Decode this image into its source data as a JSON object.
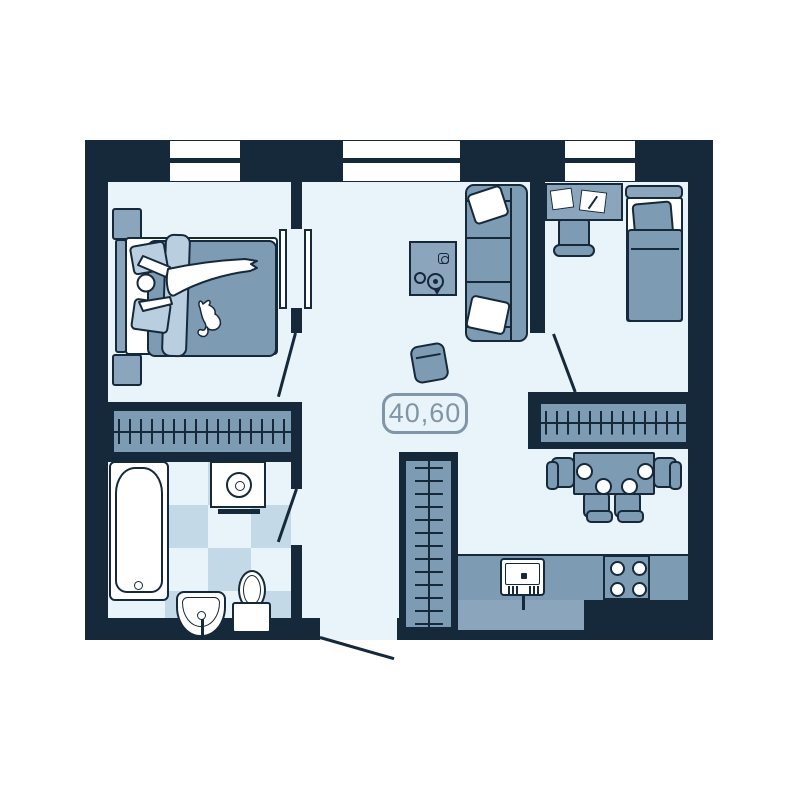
{
  "area_label": {
    "value": "40,60"
  },
  "colors": {
    "wall": "#16293A",
    "floor": "#E8F3FA",
    "furniture": "#7E9BB4",
    "furniture_light": "#8AA5BC",
    "pale": "#B9CFDF",
    "tile": "#C4D9E8",
    "fixture_white": "#FFFFFF",
    "label": "#8195A7",
    "page_background": "#FFFFFF"
  },
  "plan": {
    "type": "apartment-floor-plan",
    "windows_on_top_wall": 3,
    "door_swings": 4,
    "furniture_icons": [
      "double-bed",
      "person-figure",
      "cat-figure",
      "nightstand",
      "wardrobe-rail",
      "door-panels",
      "sofa",
      "throw-pillow",
      "coffee-table",
      "teapot",
      "cup",
      "ottoman",
      "desk",
      "papers",
      "desk-chair",
      "single-bed",
      "dining-table",
      "dining-chair",
      "plate",
      "bathtub",
      "washing-machine",
      "toilet",
      "wash-basin",
      "kitchen-counter",
      "kitchen-sink",
      "stove-burners"
    ]
  }
}
